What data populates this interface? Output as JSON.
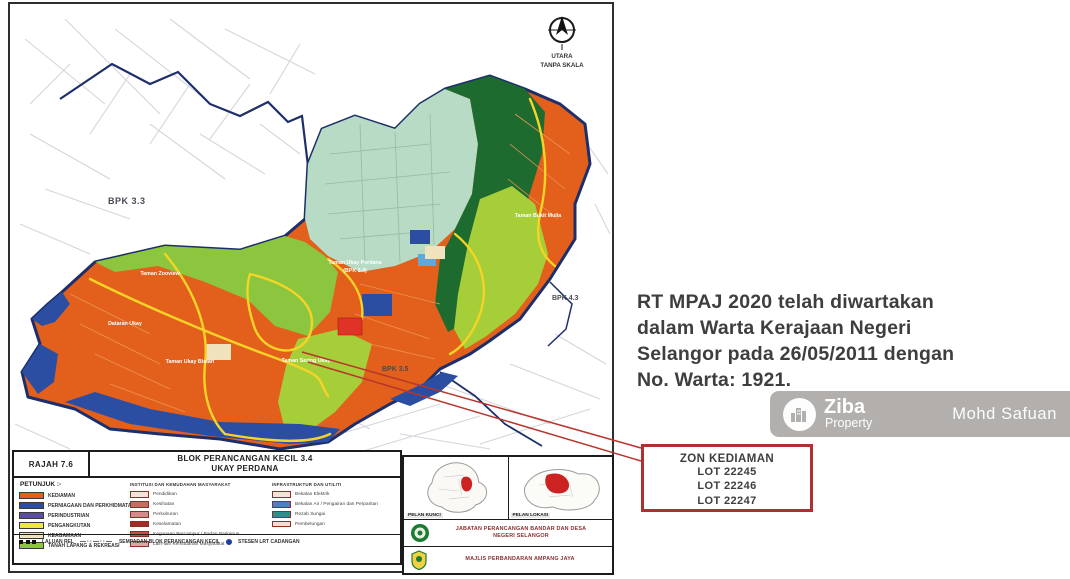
{
  "map": {
    "compass": {
      "line1": "UTARA",
      "line2": "TANPA SKALA"
    },
    "bpk_labels": {
      "northwest": "BPK 3.3",
      "east": "BPK 4.3",
      "southeast": "BPK 3.5"
    },
    "area_labels": [
      "Taman Zooview",
      "Dataran Ukay",
      "Taman Ukay Bistari",
      "Taman Sering Ukay",
      "Taman Ukay Perdana",
      "(BPK 3.4)",
      "Taman Bukit Mulia"
    ],
    "highlight_color": "#e03226",
    "boundary_color": "#1d2f6b"
  },
  "legend": {
    "figure_no": "RAJAH 7.6",
    "title_line1": "BLOK PERANCANGAN KECIL 3.4",
    "title_line2": "UKAY PERDANA",
    "key_label": "PETUNJUK :-",
    "col1": [
      {
        "label": "KEDIAMAN",
        "color": "#E2601C"
      },
      {
        "label": "PERNIAGAAN DAN PERKHIDMATAN",
        "color": "#2B4EA2"
      },
      {
        "label": "PERINDUSTRIAN",
        "color": "#5C4E9E"
      },
      {
        "label": "PENGANGKUTAN",
        "color": "#EFE93C"
      },
      {
        "label": "KEAGAMAAN",
        "color": "#F0E3C0"
      },
      {
        "label": "TANAH LAPANG & REKREASI",
        "color": "#8CC63F"
      }
    ],
    "col2": {
      "header": "INSTITUSI DAN KEMUDAHAN MASYARAKAT",
      "items": [
        {
          "label": "Pendidikan",
          "color": "#F6E2DE"
        },
        {
          "label": "Kesihatan",
          "color": "#C96B63"
        },
        {
          "label": "Perkuburan",
          "color": "#CC8F8A"
        },
        {
          "label": "Keselamatan",
          "color": "#A32C26"
        },
        {
          "label": "Kegunaan Bercampur / Badan Berkanun",
          "color": "#C4524A"
        },
        {
          "label": "Lain-lain Kemudahan Masyarakat",
          "color": "#D9A8A2"
        }
      ]
    },
    "col3": {
      "header": "INFRASTRUKTUR DAN UTILITI",
      "items": [
        {
          "label": "Bekalan Elektrik",
          "color": "#F7E3DB"
        },
        {
          "label": "Bekalan Air / Pengairan dan Perparitan",
          "color": "#4E7FC0"
        },
        {
          "label": "Rezab Sungai",
          "color": "#2E8F8A"
        },
        {
          "label": "Pembetungan",
          "color": "#F4DBD3"
        }
      ]
    },
    "bottom_row": {
      "rail_label": "LALUAN REL",
      "boundary_label": "SEMPADAN BLOK PERANCANGAN KECIL",
      "station_label": "STESEN LRT CADANGAN",
      "station_color": "#1a3f9e"
    }
  },
  "info_panel": {
    "key_plan": "PELAN KUNCI",
    "location_plan": "PELAN LOKASI",
    "department_line1": "JABATAN PERANCANGAN BANDAR DAN DESA",
    "department_line2": "NEGERI SELANGOR",
    "council": "MAJLIS PERBANDARAN AMPANG JAYA"
  },
  "gazette_note": {
    "lines": [
      "RT MPAJ 2020 telah diwartakan",
      "dalam Warta Kerajaan Negeri",
      "Selangor pada 26/05/2011 dengan",
      "No. Warta: 1921."
    ]
  },
  "callout": {
    "title": "ZON KEDIAMAN",
    "lots": [
      "LOT 22245",
      "LOT 22246",
      "LOT 22247"
    ],
    "border_color": "#b03030"
  },
  "watermark": {
    "brand": "Ziba",
    "brand_sub": "Property",
    "author": "Mohd Safuan"
  }
}
